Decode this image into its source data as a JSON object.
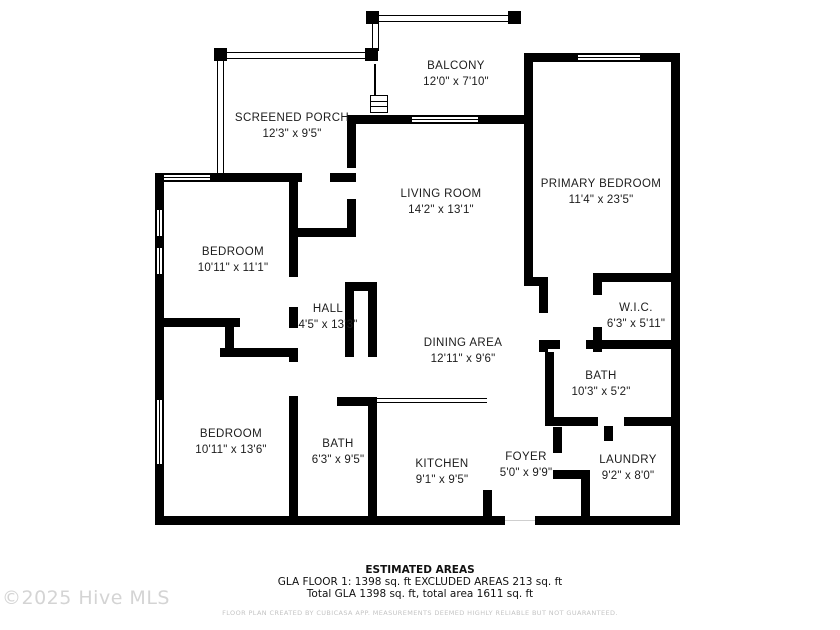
{
  "rooms": {
    "balcony": {
      "name": "BALCONY",
      "dims": "12'0\" x 7'10\""
    },
    "screened_porch": {
      "name": "SCREENED PORCH",
      "dims": "12'3\" x 9'5\""
    },
    "living_room": {
      "name": "LIVING ROOM",
      "dims": "14'2\" x 13'1\""
    },
    "primary_bedroom": {
      "name": "PRIMARY BEDROOM",
      "dims": "11'4\" x 23'5\""
    },
    "bedroom_1": {
      "name": "BEDROOM",
      "dims": "10'11\" x 11'1\""
    },
    "hall": {
      "name": "HALL",
      "dims": "4'5\" x 13'3\""
    },
    "wic": {
      "name": "W.I.C.",
      "dims": "6'3\" x 5'11\""
    },
    "dining_area": {
      "name": "DINING AREA",
      "dims": "12'11\" x 9'6\""
    },
    "bath_primary": {
      "name": "BATH",
      "dims": "10'3\" x 5'2\""
    },
    "bedroom_2": {
      "name": "BEDROOM",
      "dims": "10'11\" x 13'6\""
    },
    "bath_hall": {
      "name": "BATH",
      "dims": "6'3\" x 9'5\""
    },
    "kitchen": {
      "name": "KITCHEN",
      "dims": "9'1\" x 9'5\""
    },
    "foyer": {
      "name": "FOYER",
      "dims": "5'0\" x 9'9\""
    },
    "laundry": {
      "name": "LAUNDRY",
      "dims": "9'2\" x 8'0\""
    }
  },
  "estimated_areas": {
    "heading": "ESTIMATED AREAS",
    "line1": "GLA FLOOR 1: 1398 sq. ft EXCLUDED AREAS 213 sq. ft",
    "line2": "Total GLA 1398 sq. ft, total area 1611 sq. ft"
  },
  "disclaimer": "FLOOR PLAN CREATED BY CUBICASA APP. MEASUREMENTS DEEMED HIGHLY RELIABLE BUT NOT GUARANTEED.",
  "watermark": "©2025 Hive MLS",
  "colors": {
    "wall": "#000000",
    "background": "#ffffff",
    "label_text": "#1c1c1c",
    "watermark": "#d4d4d4",
    "disclaimer": "#c4c4c4"
  }
}
